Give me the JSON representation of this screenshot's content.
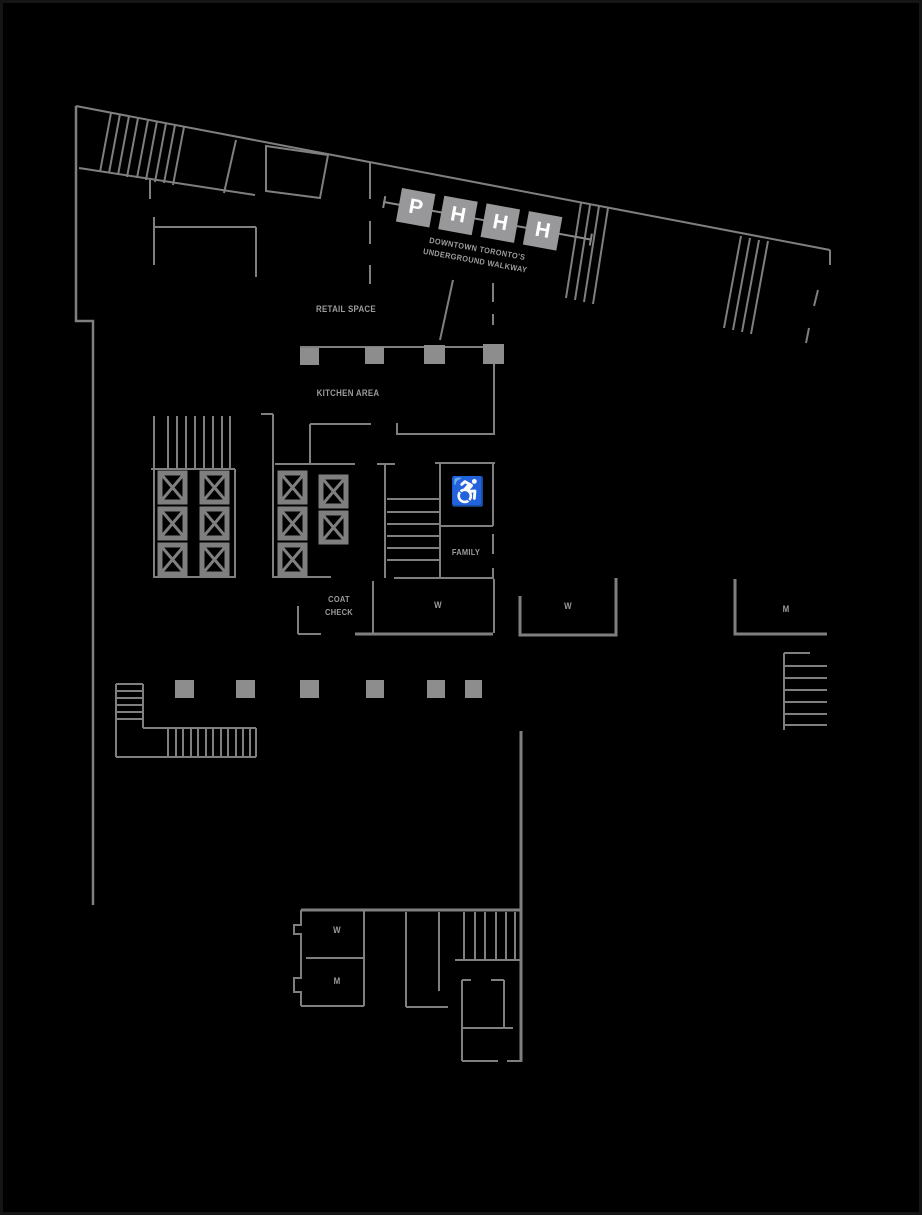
{
  "path_logo": {
    "letters": [
      "P",
      "H",
      "H",
      "H"
    ],
    "subtitle_line1": "DOWNTOWN TORONTO'S",
    "subtitle_line2": "UNDERGROUND WALKWAY",
    "box_color": "#98989a",
    "letter_color": "#ffffff"
  },
  "labels": {
    "retail_space": "RETAIL SPACE",
    "kitchen_area": "KITCHEN AREA",
    "family": "FAMILY",
    "coat_check_line1": "COAT",
    "coat_check_line2": "CHECK",
    "washroom_w_main": "W",
    "washroom_w_east": "W",
    "washroom_m_east": "M",
    "washroom_w_south": "W",
    "washroom_m_south": "M"
  },
  "icons": {
    "wheelchair": "♿"
  },
  "colors": {
    "background": "#000000",
    "wall": "#7f7f7f",
    "column": "#8d8d8d",
    "text": "#9c9c9c"
  }
}
